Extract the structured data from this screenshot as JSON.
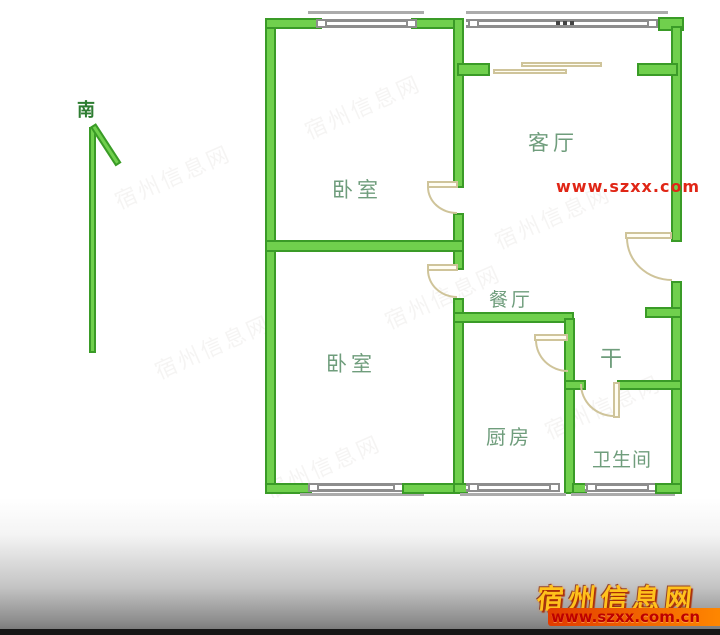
{
  "meta": {
    "title": "apartment floor plan",
    "width_px": 720,
    "height_px": 635
  },
  "compass": {
    "label": "南"
  },
  "rooms": [
    {
      "id": "bedroom-1",
      "label": "卧室"
    },
    {
      "id": "living-room",
      "label": "客厅"
    },
    {
      "id": "bedroom-2",
      "label": "卧室"
    },
    {
      "id": "dining-room",
      "label": "餐厅"
    },
    {
      "id": "dry-area",
      "label": "干"
    },
    {
      "id": "kitchen",
      "label": "厨房"
    },
    {
      "id": "bathroom",
      "label": "卫生间"
    }
  ],
  "watermarks": {
    "mid_url": "www.szxx.com",
    "site_name": "宿州信息网",
    "site_url": "www.szxx.com.cn",
    "faint_text": "宿州信息网"
  },
  "colors": {
    "wall_fill": "#70d04d",
    "wall_edge": "#3a9b27",
    "door_tan": "#cfc49a",
    "window_gray": "#8d8d8d",
    "label_green": "#6f9d7c",
    "compass_green": "#2e7d32",
    "brand_yellow": "#ffc21c",
    "brand_red": "#e02616"
  }
}
